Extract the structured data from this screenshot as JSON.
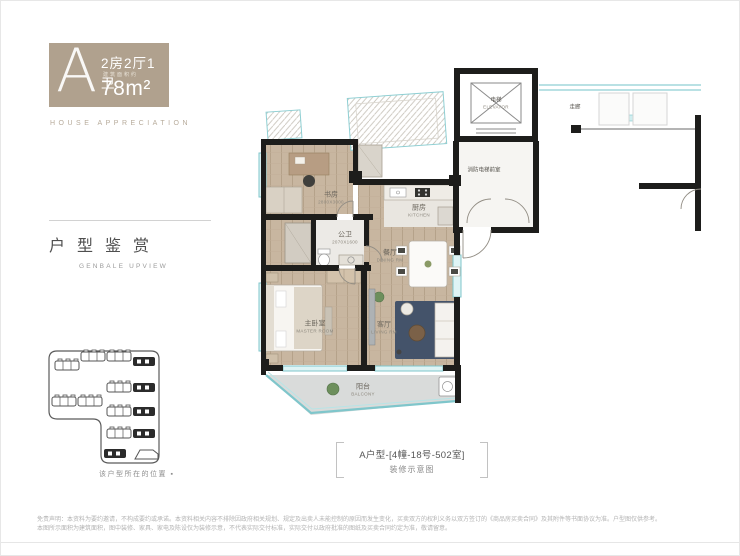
{
  "badge": {
    "letter": "A",
    "layout_label": "2房2厅1卫",
    "area_note": "建筑面积约",
    "area": "78m²",
    "tagline": "HOUSE APPRECIATION",
    "bg_color": "#b0a18e"
  },
  "section": {
    "title": "户型鉴赏",
    "subtitle": "GENBALE UPVIEW"
  },
  "siteplan": {
    "caption": "该户型所在的位置 ▪"
  },
  "floorplan": {
    "caption_line1": "A户型-[4幢-18号-502室]",
    "caption_line2": "装修示意图",
    "rooms": [
      {
        "name": "书房",
        "sub": "2800X3000"
      },
      {
        "name": "公卫",
        "sub": "2070X1600"
      },
      {
        "name": "厨房",
        "sub": "KITCHEN"
      },
      {
        "name": "餐厅",
        "sub": "DINING RM"
      },
      {
        "name": "客厅",
        "sub": "LIVING RM"
      },
      {
        "name": "主卧室",
        "sub": "MASTER ROOM"
      },
      {
        "name": "阳台",
        "sub": "BALCONY"
      },
      {
        "name": "电梯",
        "sub": "ELEVATOR"
      },
      {
        "name": "消防电梯前室",
        "sub": ""
      },
      {
        "name": "走廊",
        "sub": ""
      }
    ],
    "colors": {
      "wall": "#1d1d1b",
      "wood_floor": "#c8b6a0",
      "window": "#7fc6cb",
      "balcony_floor": "#d9dbda",
      "tile_floor": "#e9e6e0",
      "rug": "#44536a"
    }
  },
  "disclaimer": {
    "line1": "免责声明：本资料为要约邀请，不构成要约或承诺。本资料相关内容不排除因政府相关规划、规定及出卖人未能控制的原因而发生变化，买卖双方的权利义务以双方签订的《商品房买卖合同》及其附件等书面协议为准。户型图仅供参考。",
    "line2": "本图所示面积为建筑面积，图中装修、家具、家电及陈设仅为装修示意，不代表实际交付标准，实际交付以政府批准的图纸及买卖合同约定为准，敬请留意。"
  }
}
